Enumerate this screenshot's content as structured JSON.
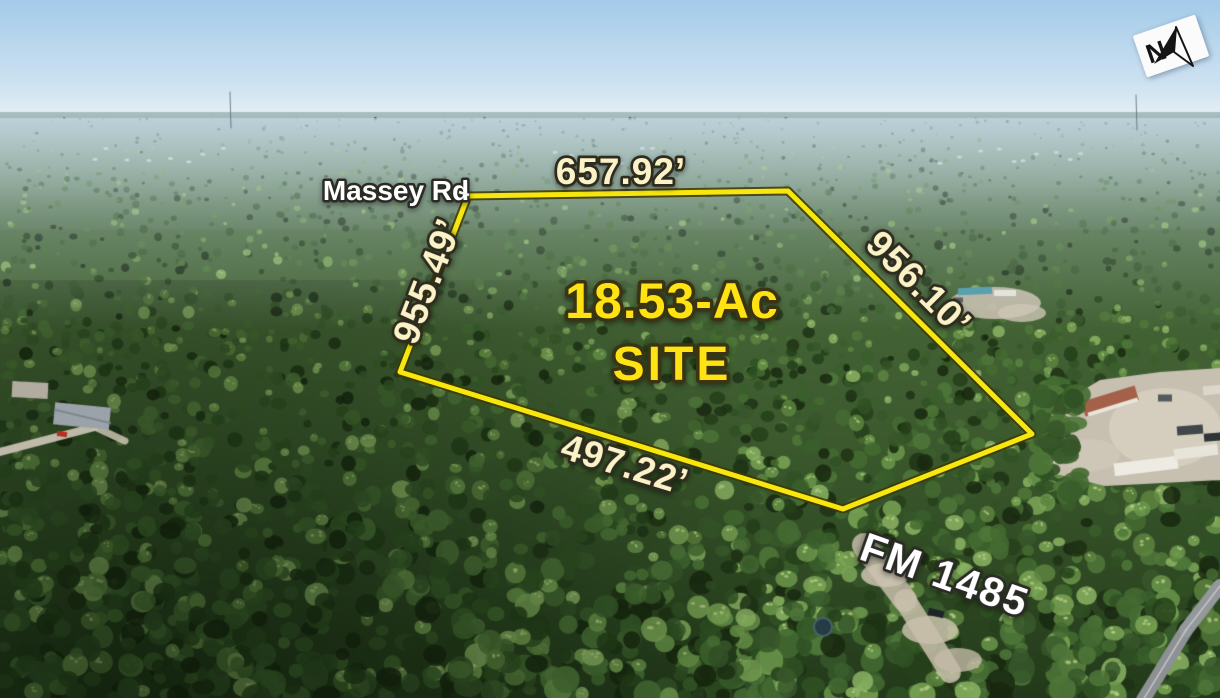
{
  "site": {
    "acreage_line1": "18.53-Ac",
    "acreage_line2": "SITE",
    "boundary_labels": {
      "north": "657.92’",
      "west": "955.49’",
      "east": "956.10’",
      "south": "497.22’"
    }
  },
  "roads": {
    "massey_rd": "Massey Rd",
    "fm_1485": "FM 1485"
  },
  "compass": {
    "label": "N"
  },
  "colors": {
    "boundary_line": "#f7e70e",
    "site_label": "#ffe212",
    "dimension_text": "#fbf2c8",
    "road_text": "#ffffff"
  }
}
